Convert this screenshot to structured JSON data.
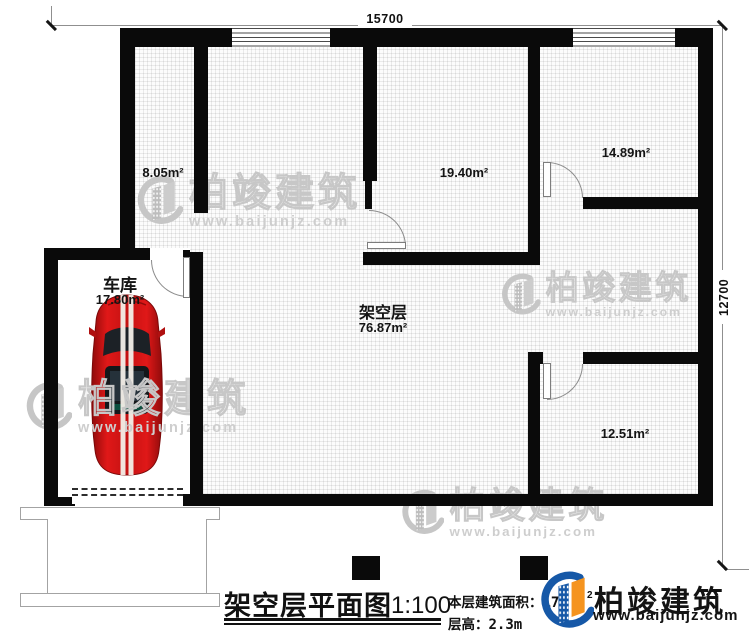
{
  "dimensions": {
    "width_label": "15700",
    "height_label": "12700"
  },
  "rooms": {
    "stair_room": {
      "area": "8.05m²"
    },
    "hall_room": {
      "area": "19.40m²"
    },
    "bedroom_top": {
      "area": "14.89m²"
    },
    "garage": {
      "name": "车库",
      "area": "17.80m²"
    },
    "stilt_floor": {
      "name": "架空层",
      "area": "76.87m²"
    },
    "bedroom_bottom": {
      "area": "12.51m²"
    }
  },
  "footer": {
    "title": "架空层平面图",
    "scale": "1:100",
    "building_area_label": "本层建筑面积：",
    "building_area_visible": "17",
    "building_area_sup": "2",
    "floor_height_label": "层高：",
    "floor_height_value": "2.3m"
  },
  "brand": {
    "name": "柏竣建筑",
    "website": "www.baijunjz.com"
  },
  "watermark": {
    "name": "柏竣建筑",
    "website": "www.baijunjz.com"
  },
  "colors": {
    "brand_blue": "#1658a7",
    "brand_orange": "#f5941f",
    "wall": "#0a0a0a",
    "car_red": "#c41212"
  }
}
